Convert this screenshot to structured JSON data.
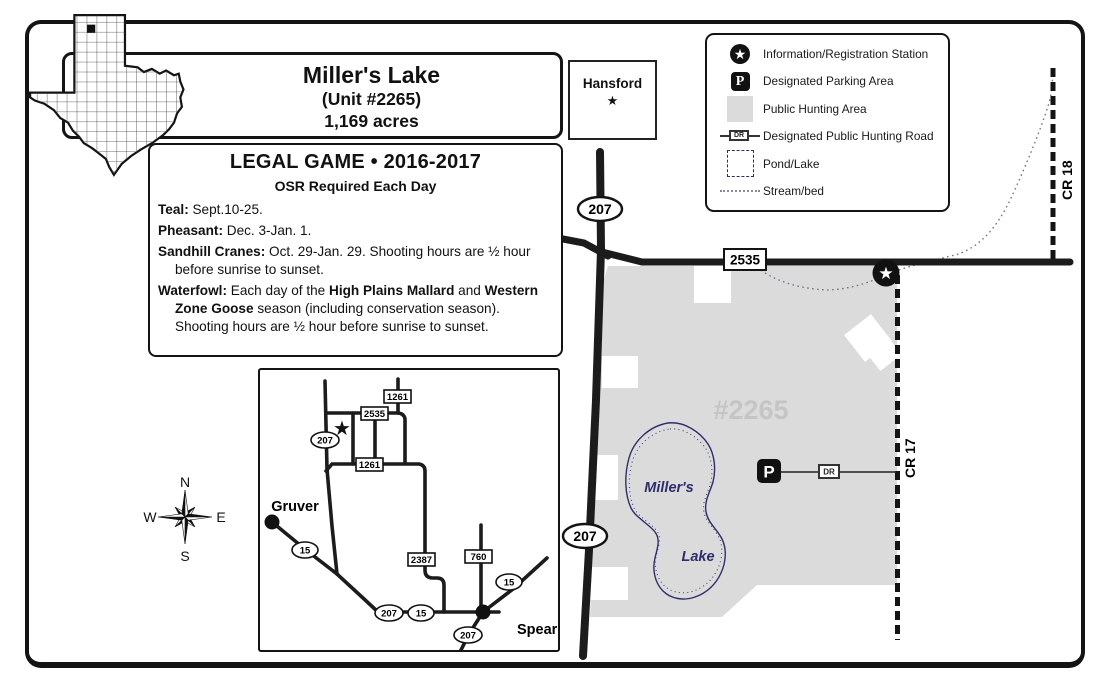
{
  "title": {
    "line1": "Miller's Lake",
    "line2": "(Unit #2265)",
    "line3": "1,169 acres"
  },
  "county_box": {
    "name": "Hansford",
    "star": "★"
  },
  "legend": {
    "items": [
      {
        "icon": "registration-star-icon",
        "label": "Information/Registration Station"
      },
      {
        "icon": "parking-icon",
        "label": "Designated Parking Area"
      },
      {
        "icon": "hunting-area-swatch",
        "label": "Public Hunting Area"
      },
      {
        "icon": "designated-road-symbol",
        "label": "Designated Public Hunting Road"
      },
      {
        "icon": "pond-swatch",
        "label": "Pond/Lake"
      },
      {
        "icon": "stream-symbol",
        "label": "Stream/bed"
      }
    ],
    "dr_text": "DR",
    "parking_letter": "P",
    "star": "★"
  },
  "legal_game": {
    "title": "LEGAL GAME • 2016-2017",
    "subtitle": "OSR Required Each Day",
    "items": [
      {
        "segments": [
          {
            "text": "Teal:",
            "bold": true
          },
          {
            "text": " Sept.10-25.",
            "bold": false
          }
        ]
      },
      {
        "segments": [
          {
            "text": "Pheasant:",
            "bold": true
          },
          {
            "text": " Dec. 3-Jan. 1.",
            "bold": false
          }
        ]
      },
      {
        "segments": [
          {
            "text": "Sandhill Cranes:",
            "bold": true
          },
          {
            "text": " Oct. 29-Jan. 29. Shooting hours are ½ hour before sunrise to sunset.",
            "bold": false
          }
        ]
      },
      {
        "segments": [
          {
            "text": "Waterfowl:",
            "bold": true
          },
          {
            "text": " Each day of the ",
            "bold": false
          },
          {
            "text": "High Plains Mallard",
            "bold": true
          },
          {
            "text": " and ",
            "bold": false
          },
          {
            "text": "Western Zone Goose",
            "bold": true
          },
          {
            "text": " season (including conservation season). Shooting hours are ½ hour before sunrise to sunset.",
            "bold": false
          }
        ]
      }
    ]
  },
  "compass": {
    "north": "N",
    "east": "E",
    "south": "S",
    "west": "W"
  },
  "main_map": {
    "unit_label": "#2265",
    "lake_line1": "Miller's",
    "lake_line2": "Lake",
    "hwy_207": "207",
    "fm_2535": "2535",
    "cr_17": "CR 17",
    "cr_18": "CR 18",
    "parking_letter": "P",
    "dr_text": "DR",
    "station_star": "★"
  },
  "inset_map": {
    "towns": {
      "gruver": "Gruver",
      "spearman": "Spearman"
    },
    "star": "★",
    "shields": {
      "hwy_207": "207",
      "hwy_15": "15",
      "fm_1261": "1261",
      "fm_2535": "2535",
      "fm_2387": "2387",
      "fm_760": "760"
    }
  },
  "colors": {
    "hunting_area": "#dbdbdb",
    "unit_label_gray": "#c5c5c5",
    "lake_outline": "#2d2d6e",
    "road_black": "#1c1c1c",
    "stream_gray": "#70707e"
  }
}
